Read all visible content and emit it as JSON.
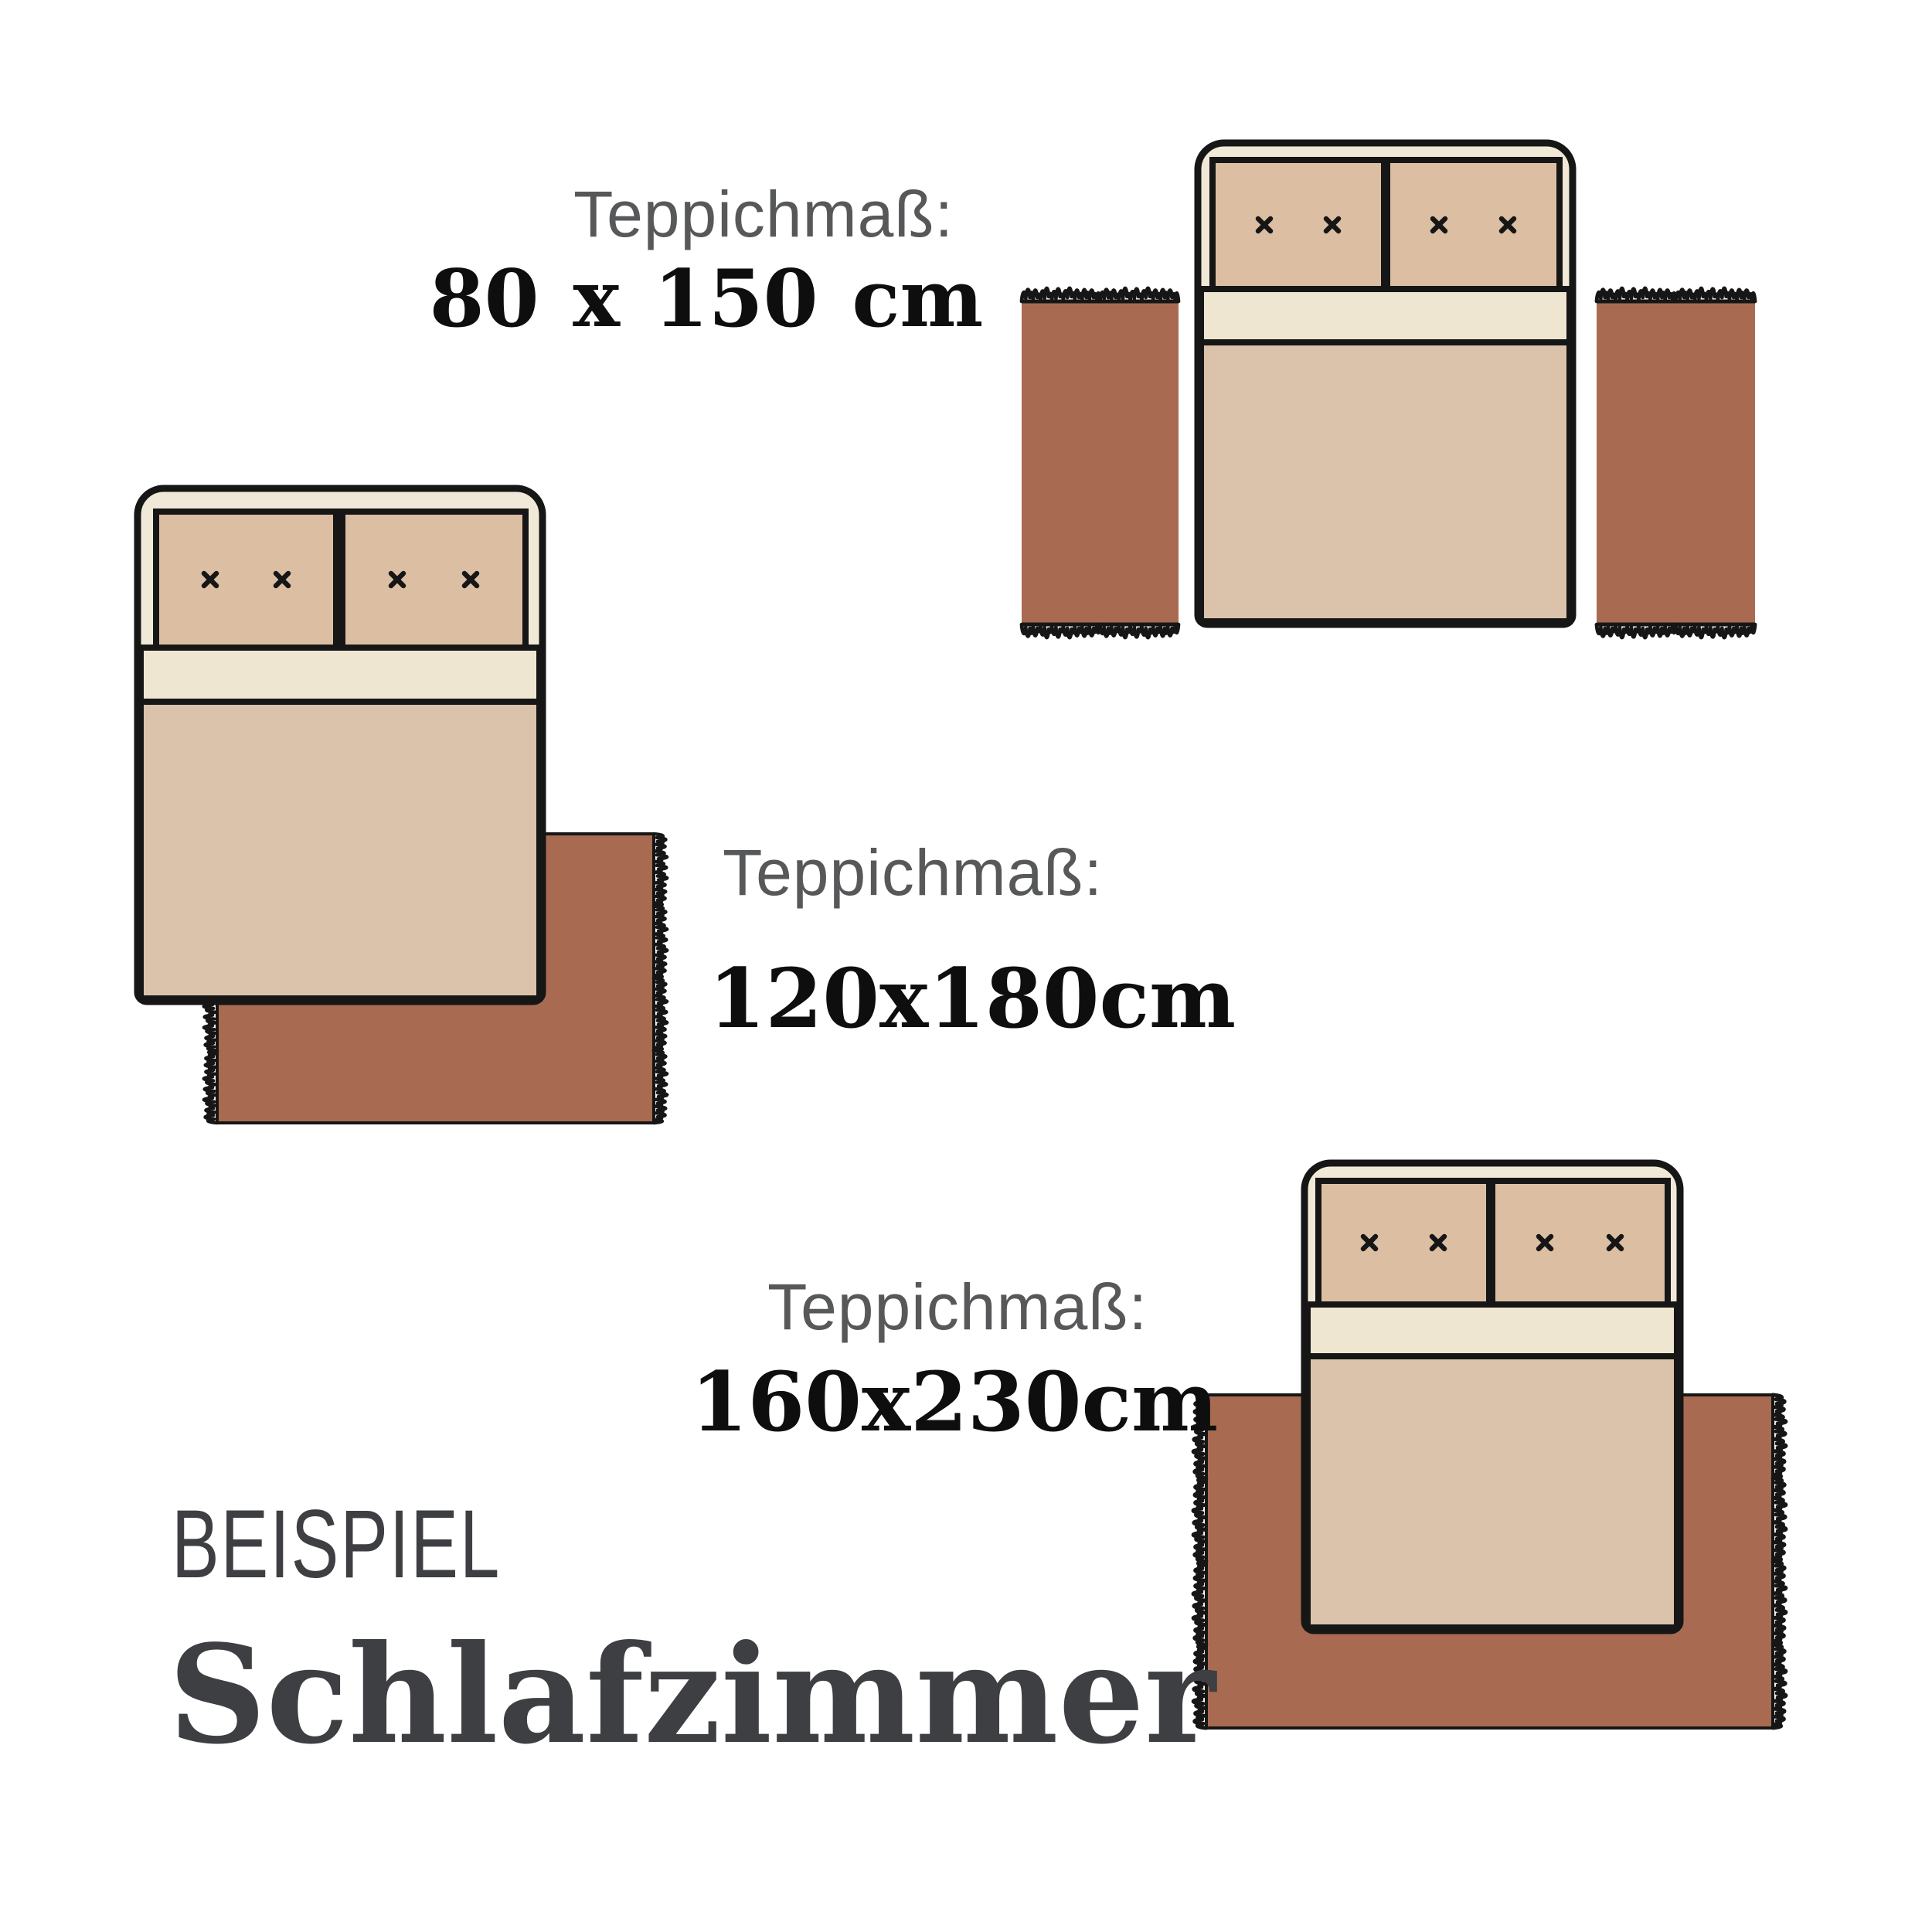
{
  "examples": [
    {
      "id": "80x150",
      "label": "Teppichmaß:",
      "size": "80 x 150 cm",
      "layout": "two runner rugs on both sides of the bed"
    },
    {
      "id": "120x180",
      "label": "Teppichmaß:",
      "size": "120x180cm",
      "layout": "rug under the foot corner of the bed"
    },
    {
      "id": "160x230",
      "label": "Teppichmaß:",
      "size": "160x230cm",
      "layout": "large rug under the lower part of the bed"
    }
  ],
  "footer": {
    "eyebrow": "BEISPIEL",
    "title": "Schlafzimmer"
  },
  "colors": {
    "background": "#ffffff",
    "outline": "#161616",
    "rug": "#a86b51",
    "bed_frame": "#f1e9d7",
    "pillow": "#dcbfa3",
    "sheet": "#eee6d1",
    "blanket": "#dbc2aa",
    "label_gray": "#57585a",
    "dimension_black": "#0e0e0e",
    "footer_gray": "#3e3f42"
  }
}
